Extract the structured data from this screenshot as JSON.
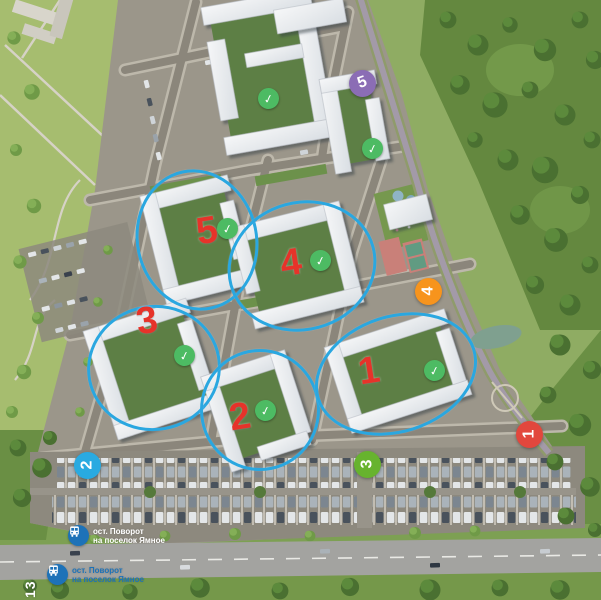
{
  "map": {
    "title": "Residential complex master plan — aerial render",
    "page_number": "13",
    "colors": {
      "highlight_ellipse": "#2aa7e0",
      "queue_number": "#e6332a",
      "completed_badge": "#4dbb63",
      "bus_stop_blue": "#1d72b8"
    },
    "icons": {
      "check_glyph": "✓",
      "bus_icon": "bus"
    },
    "route_markers": [
      {
        "label": "1",
        "x": 529,
        "y": 434,
        "color": "#e2473d",
        "rotation": -90
      },
      {
        "label": "2",
        "x": 87,
        "y": 465,
        "color": "#29aae1",
        "rotation": -90
      },
      {
        "label": "3",
        "x": 367,
        "y": 464,
        "color": "#67b32e",
        "rotation": -90
      },
      {
        "label": "4",
        "x": 428,
        "y": 291,
        "color": "#f7941d",
        "rotation": -90
      },
      {
        "label": "5",
        "x": 362,
        "y": 83,
        "color": "#8b6db5",
        "rotation": -20
      }
    ],
    "queue_numbers": [
      {
        "label": "1",
        "x": 369,
        "y": 378
      },
      {
        "label": "2",
        "x": 240,
        "y": 424
      },
      {
        "label": "3",
        "x": 147,
        "y": 328
      },
      {
        "label": "4",
        "x": 291,
        "y": 270
      },
      {
        "label": "5",
        "x": 207,
        "y": 238
      }
    ],
    "completed_badges": [
      {
        "x": 268,
        "y": 98
      },
      {
        "x": 372,
        "y": 148
      },
      {
        "x": 227,
        "y": 228
      },
      {
        "x": 320,
        "y": 260
      },
      {
        "x": 184,
        "y": 355
      },
      {
        "x": 265,
        "y": 410
      },
      {
        "x": 434,
        "y": 370
      }
    ],
    "highlight_ellipses": [
      {
        "cx": 197,
        "cy": 240,
        "rx": 58,
        "ry": 68,
        "rot": -12
      },
      {
        "cx": 302,
        "cy": 266,
        "rx": 72,
        "ry": 62,
        "rot": -15
      },
      {
        "cx": 154,
        "cy": 368,
        "rx": 64,
        "ry": 60,
        "rot": -10
      },
      {
        "cx": 260,
        "cy": 410,
        "rx": 57,
        "ry": 58,
        "rot": 0
      },
      {
        "cx": 396,
        "cy": 374,
        "rx": 80,
        "ry": 56,
        "rot": -18
      }
    ],
    "bus_stops": [
      {
        "line1": "ост. Поворот",
        "line2": "на поселок Ямное",
        "x": 68,
        "y": 525,
        "text_color": "#ffffff"
      },
      {
        "line1": "ост. Поворот",
        "line2": "на поселок Ямное",
        "x": 47,
        "y": 564,
        "text_color": "#1d72b8"
      }
    ]
  }
}
